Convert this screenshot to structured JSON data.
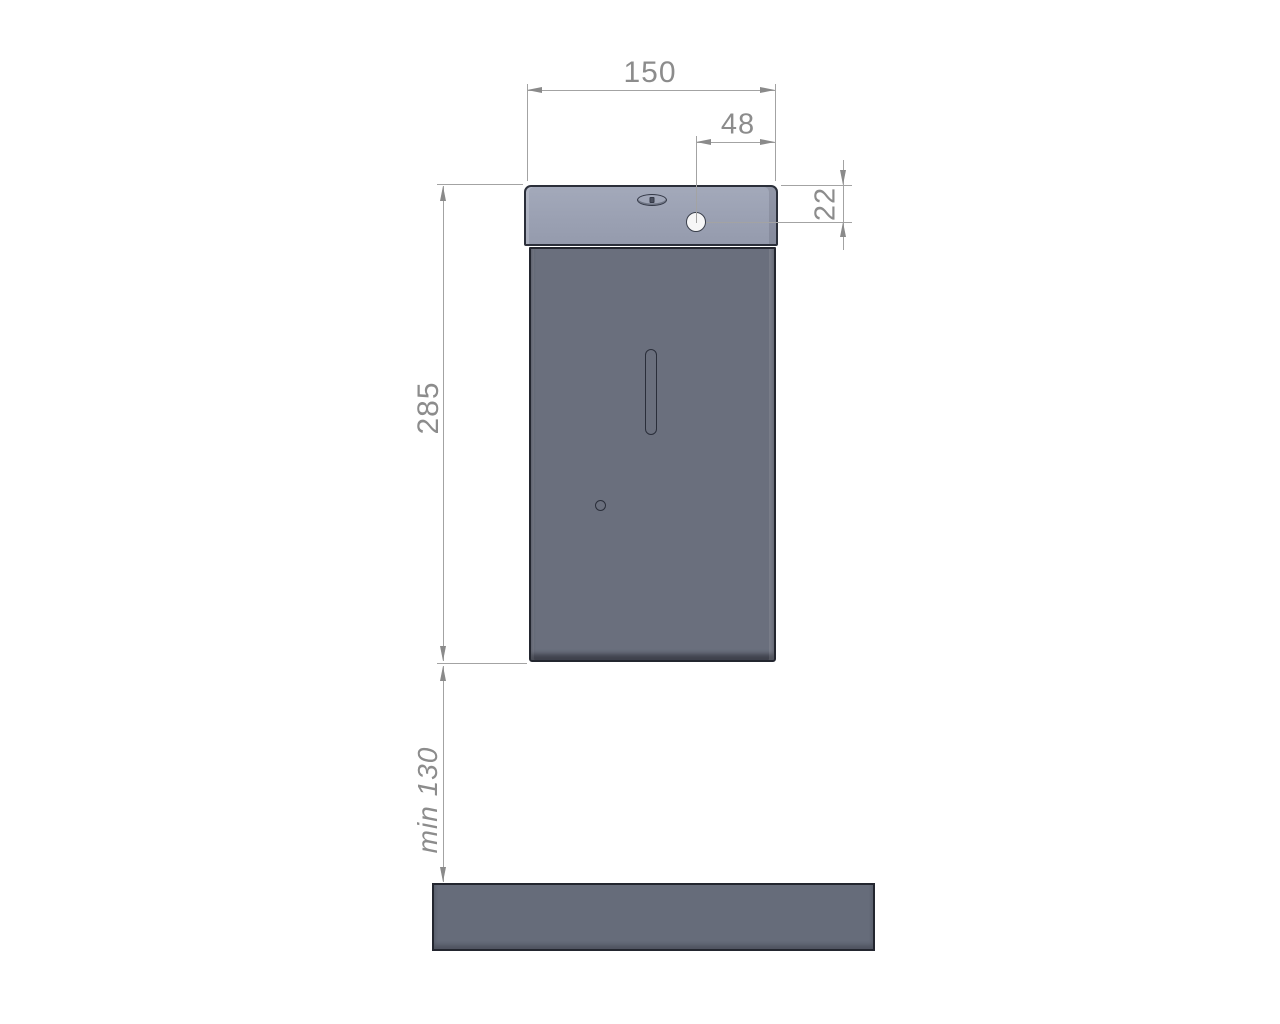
{
  "drawing": {
    "type": "technical dimension drawing - wall mounted dispenser, front view",
    "units_implied": "mm",
    "dimensions": {
      "overall_width": "150",
      "hole_offset_x": "48",
      "hole_offset_y": "22",
      "body_height": "285",
      "clearance_below": "min 130"
    },
    "colors": {
      "background": "#ffffff",
      "lid_fill": "#9aa0b2",
      "body_fill": "#6a6f7d",
      "surface_fill": "#666c7a",
      "outline": "#23262f",
      "dimension_line": "#a3a3a3",
      "arrowhead": "#8a8a8a",
      "dimension_text": "#8c8c8c"
    }
  }
}
